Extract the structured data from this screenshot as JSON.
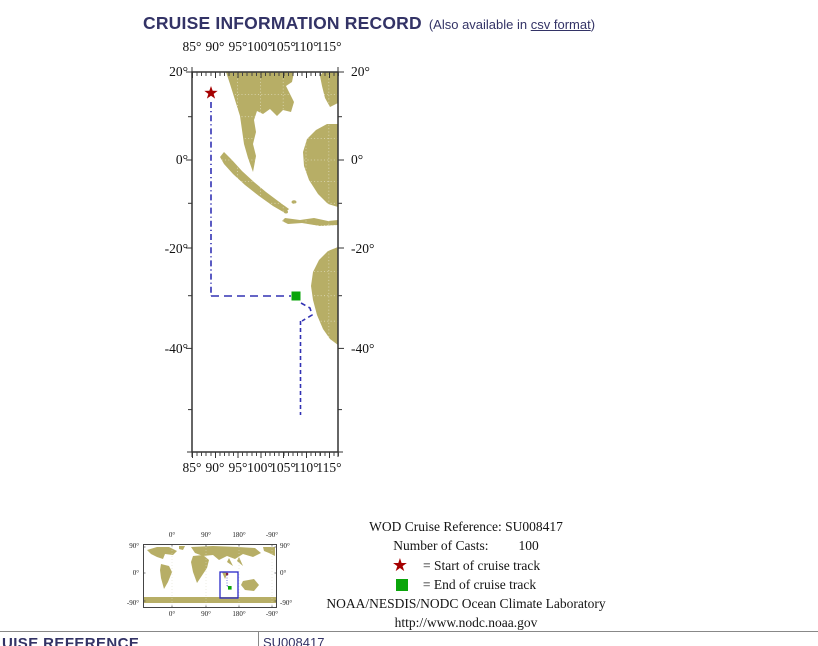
{
  "header": {
    "title": "CRUISE INFORMATION RECORD",
    "availability_prefix": "(Also available in ",
    "availability_link": "csv format",
    "availability_suffix": ")"
  },
  "cruise_map": {
    "top_axis_labels": [
      "85°",
      "90°",
      "95°",
      "100°",
      "105°",
      "110°",
      "115°"
    ],
    "bottom_axis_labels": [
      "85°",
      "90°",
      "95°",
      "100°",
      "105°",
      "110°",
      "115°"
    ],
    "left_axis_labels": [
      "20°",
      "0°",
      "-20°",
      "-40°"
    ],
    "right_axis_labels": [
      "20°",
      "0°",
      "-20°",
      "-40°"
    ],
    "start_marker": "red star near 89°E, 15°N",
    "end_marker": "green square near 108°E, -29°"
  },
  "legend": {
    "reference_label": "WOD Cruise Reference:",
    "reference_value": "SU008417",
    "casts_label": "Number of Casts:",
    "casts_value": "100",
    "start_text": "= Start of cruise track",
    "end_text": "= End of cruise track",
    "organization": "NOAA/NESDIS/NODC Ocean Climate Laboratory",
    "website": "http://www.nodc.noaa.gov"
  },
  "world_inset": {
    "top_labels": [
      "0°",
      "90°",
      "180°",
      "-90°"
    ],
    "bottom_labels": [
      "0°",
      "90°",
      "180°",
      "-90°"
    ],
    "left_labels": [
      "90°",
      "0°",
      "-90°"
    ],
    "right_labels": [
      "90°",
      "0°",
      "-90°"
    ]
  },
  "record_table": {
    "visible_row_label": "UISE REFERENCE",
    "visible_row_value": "SU008417"
  },
  "colors": {
    "heading": "#333366",
    "land": "#b7ae66",
    "track_blue": "#3232b4",
    "start_red": "#a50000",
    "end_green": "#0aa50a"
  }
}
